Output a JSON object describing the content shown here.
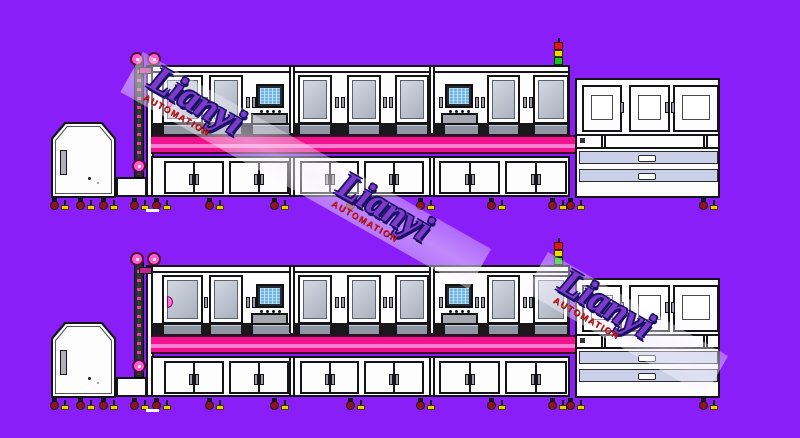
{
  "watermark": {
    "brand": "Lianyi",
    "subtitle": "AUTOMATION"
  },
  "colors": {
    "bg": "#8A1EF8",
    "ink": "#141418",
    "body": "#FDFDFE",
    "glass_light": "#D3D8E0",
    "glass_dark": "#AAB1BF",
    "glass_edge": "#596070",
    "strip_bg": "#17171C",
    "strip_win": "#8F95A3",
    "pink_deep": "#F0128E",
    "pink_light": "#FF7ED2",
    "pink_edge": "#3B0524",
    "drawer": "#CAD0E8",
    "handle_gray": "#9A9AA4",
    "wheel": "#8E1620",
    "foot": "#E6CF00",
    "sig_red": "#E51515",
    "sig_yellow": "#F0D800",
    "sig_green": "#1AC41A",
    "pulley": "#FF5ECF",
    "elev": "#26262C",
    "arm": "#C2268E",
    "hmi_screen": "#6CB4E4",
    "hmi_frame": "#2A2A31",
    "wm_brand": "#7B3CC8",
    "wm_outline": "#1A1066",
    "wm_sub": "#D21A1A"
  },
  "lines": [
    {
      "name": "production-line-top",
      "top": 0
    },
    {
      "name": "production-line-bottom",
      "top": 200
    }
  ],
  "watermarks": [
    {
      "x": 143,
      "y": 52,
      "angle": 29.5,
      "length": 400,
      "groups": [
        {
          "offset": 20
        },
        {
          "offset": 236
        }
      ]
    },
    {
      "x": 548,
      "y": 252,
      "angle": 30,
      "length": 208,
      "groups": [
        {
          "offset": 26
        }
      ]
    }
  ]
}
